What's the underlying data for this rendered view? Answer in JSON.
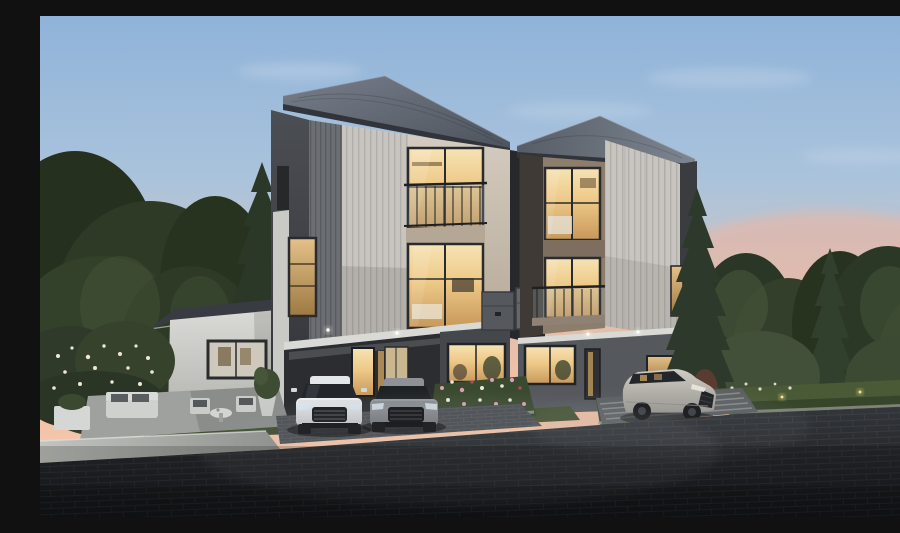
{
  "scene": {
    "description": "Dusk architectural rendering of twin modern three-storey townhouses with warm-lit windows and glass balconies, a single-storey white side wing with an outdoor patio set, a white sedan and a grey sedan parked in the left carport, a silver sedan parked by the right unit, flower beds, hedges and evergreen trees on both sides, and a dark paver road in the foreground beneath a blue-to-pink sunset sky.",
    "time_of_day": "dusk",
    "objects": [
      {
        "name": "sky",
        "label": "Sunset gradient sky with thin clouds"
      },
      {
        "name": "trees-left",
        "label": "Evergreen and deciduous trees, left side"
      },
      {
        "name": "trees-right",
        "label": "Evergreen and deciduous trees, right side"
      },
      {
        "name": "left-townhouse",
        "label": "Left three-storey townhouse, cream facade, hip roof"
      },
      {
        "name": "right-townhouse",
        "label": "Right three-storey townhouse, taupe facade, hip roof"
      },
      {
        "name": "side-wing",
        "label": "Single-storey white wing with picture window"
      },
      {
        "name": "patio-set",
        "label": "Outdoor sofa, chairs, coffee table and potted plants"
      },
      {
        "name": "utility-boxes",
        "label": "Two grey utility cabinets between units"
      },
      {
        "name": "carport",
        "label": "Left unit carport with lit entrance doors"
      },
      {
        "name": "white-sedan",
        "label": "White sedan, front view"
      },
      {
        "name": "grey-sedan",
        "label": "Grey sedan, front view"
      },
      {
        "name": "silver-sedan",
        "label": "Silver sedan, three-quarter view"
      },
      {
        "name": "flower-beds",
        "label": "Flower beds with pink and white blooms"
      },
      {
        "name": "hedges",
        "label": "Trimmed hedges with garden lights"
      },
      {
        "name": "lawn",
        "label": "Lawn strips"
      },
      {
        "name": "curb",
        "label": "Light concrete curbs"
      },
      {
        "name": "road",
        "label": "Dark charcoal paver road"
      }
    ]
  },
  "palette": {
    "sky-top": "#8fb3d9",
    "sky-mid": "#c6c5c8",
    "sky-horizon": "#f3c0a4",
    "cloud": "#f4f6f8",
    "foliage-dark": "#26301f",
    "foliage-mid": "#2e3a26",
    "foliage-light": "#46563a",
    "roof-dark": "#4d535c",
    "roof-light": "#767e8a",
    "fascia-dark": "#31343a",
    "facade-cream": "#d6cec2",
    "facade-cream-deep": "#b3a795",
    "facade-taupe": "#8d7d6c",
    "panel-light": "#c8c5c0",
    "panel-dark": "#6b6e73",
    "wall-dark": "#3a3d41",
    "trim-white": "#d9dad6",
    "window-warm": "#f6e3b4",
    "window-warm-deep": "#c7985a",
    "window-frame": "#2a2b2d",
    "glass-cool": "#aebfc8",
    "ground-wall": "#44474b",
    "lawn": "#3f4d30",
    "hedge": "#4a5a36",
    "flower-pink": "#dca0b8",
    "flower-white": "#eee6da",
    "patio-slab": "#9ea19e",
    "curb": "#c2c4c0",
    "road-top": "#33363a",
    "road-bottom": "#17181b",
    "driveway": "#5d6062",
    "car-white": "#eef0f2",
    "car-grey": "#9a9da1",
    "car-silver": "#cfccc5",
    "car-glass": "#23272b",
    "wheel": "#141517",
    "glint-warm": "#e6d27a"
  }
}
